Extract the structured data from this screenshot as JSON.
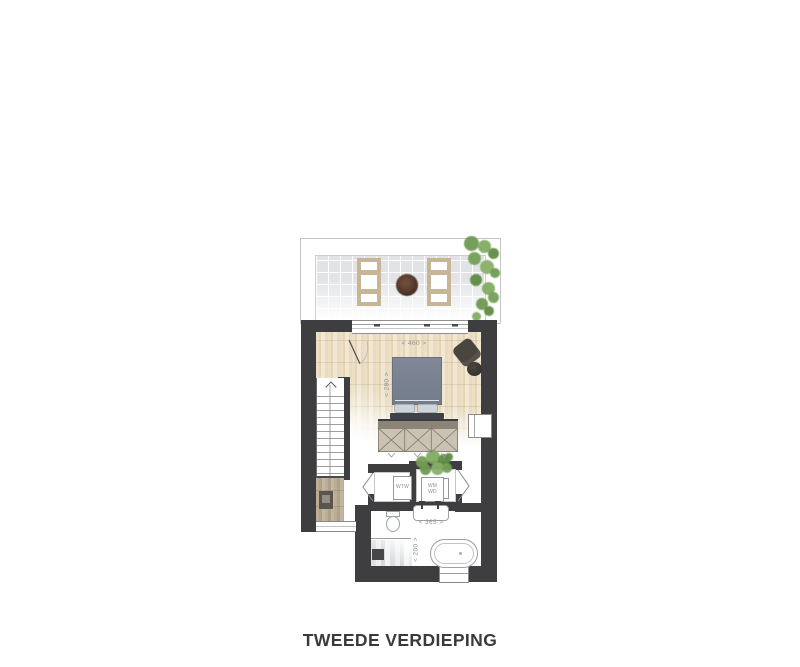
{
  "title": "TWEEDE VERDIEPING",
  "plan": {
    "labels": {
      "bedroom_width": "< 460 >",
      "bedroom_depth": "< 280 >",
      "bathroom_width": "< 365 >",
      "shower_width": "< 200 >"
    },
    "appliances": {
      "ventilation_unit": "WTW",
      "washing_machine": "WM",
      "dryer": "WD"
    },
    "features": [
      "roof-terrace",
      "terrace-tile-floor",
      "skylight",
      "climbing-plant-icon",
      "planter-icon",
      "sliding-glass-door-icon",
      "staircase-icon",
      "up-arrow-icon",
      "door-swing-icon",
      "double-bed-icon",
      "pillow-icon",
      "wardrobe-icon",
      "armchair-icon",
      "side-table-icon",
      "window-icon",
      "bifold-door-icon",
      "houseplant-icon",
      "washbasin-icon",
      "faucet-icon",
      "toilet-icon",
      "shower-icon",
      "bathtub-icon",
      "meter-cabinet-icon"
    ],
    "colors": {
      "wall": "#3e3e41",
      "wood_floor": "#e8dcc2",
      "terrace_tile": "#e2e3e6",
      "skylight_frame": "#c7b695",
      "bed_duvet": "#79818f",
      "pillow": "#cfd4da",
      "plant_green": "#74a156",
      "planter_brown": "#5a3d2e",
      "wardrobe_front": "#cac2b2",
      "wardrobe_top": "#8d8478",
      "dimension_text": "#909090",
      "title_text": "#3a3a3c"
    }
  }
}
